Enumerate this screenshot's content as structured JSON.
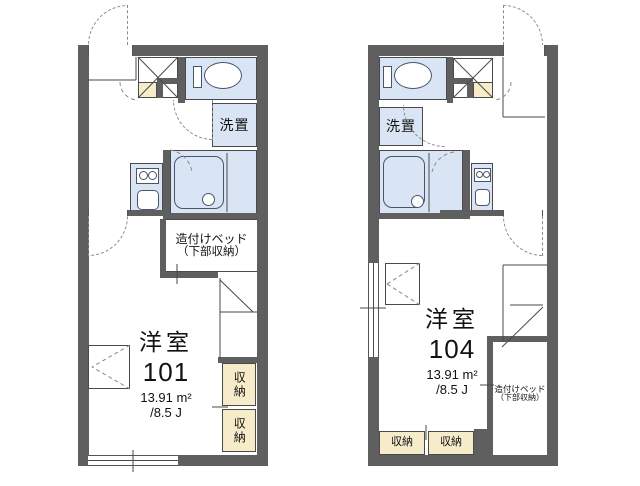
{
  "page": {
    "background": "#ffffff",
    "type": "apartment-floor-plan"
  },
  "colors": {
    "wall": "#5f5f5f",
    "water_room_fill": "#d9e5f4",
    "storage_fill": "#f6ecca",
    "line": "#4a4a4a",
    "background": "#ffffff"
  },
  "units": [
    {
      "unit_number": "101",
      "room_type": "洋室",
      "area_sqm": "13.91 m²",
      "area_tatami": "/8.5 J",
      "bed_label_line1": "造付けベッド",
      "bed_label_line2": "（下部収納）",
      "laundry_label": "洗置",
      "storage_label_1": "収納",
      "storage_label_2": "収納"
    },
    {
      "unit_number": "104",
      "room_type": "洋室",
      "area_sqm": "13.91 m²",
      "area_tatami": "/8.5 J",
      "bed_label_line1": "造付けベッド",
      "bed_label_line2": "（下部収納）",
      "laundry_label": "洗置",
      "storage_label_1": "収納",
      "storage_label_2": "収納"
    }
  ]
}
